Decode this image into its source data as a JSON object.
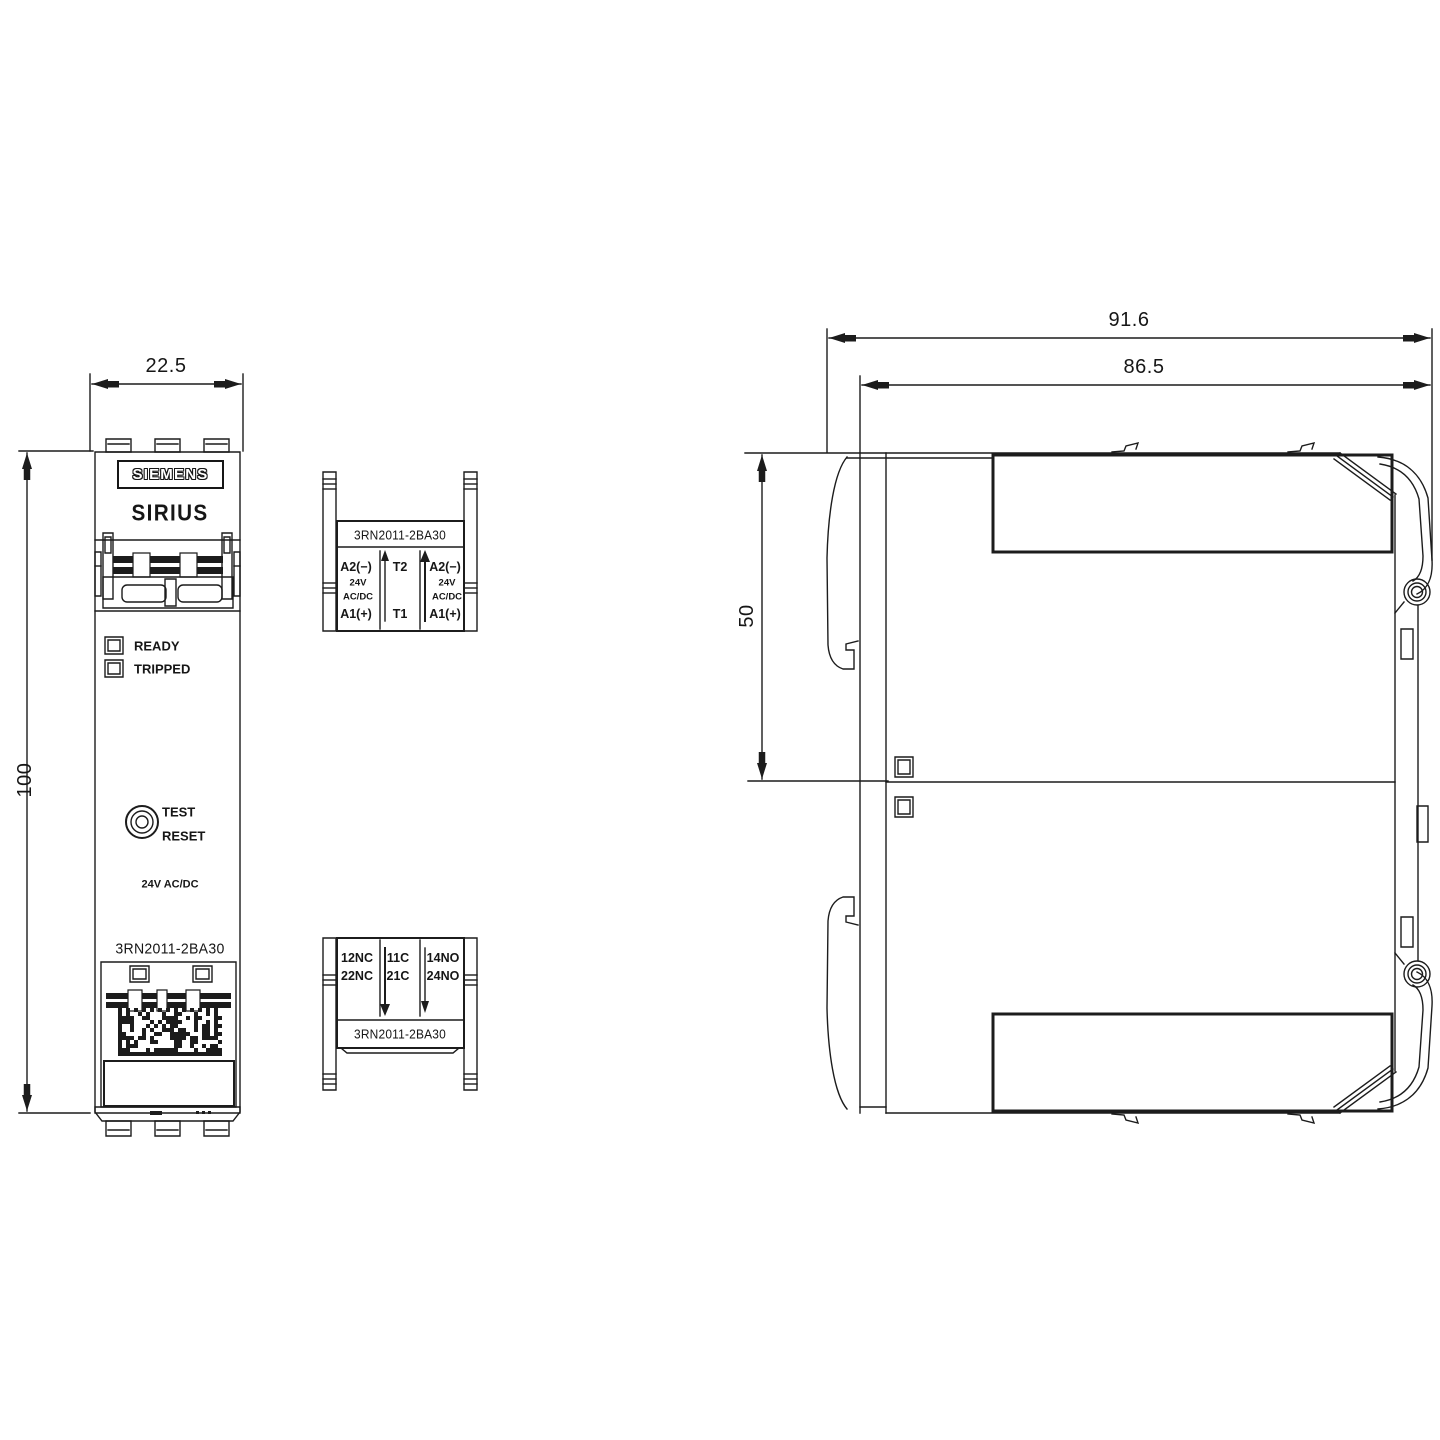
{
  "front_view": {
    "dim_width": "22.5",
    "dim_height": "100",
    "logo": "SIEMENS",
    "series": "SIRIUS",
    "led_ready": "READY",
    "led_tripped": "TRIPPED",
    "button_label_top": "TEST",
    "button_label_bottom": "RESET",
    "voltage": "24V AC/DC",
    "part_number": "3RN2011-2BA30"
  },
  "upper_terminal_block": {
    "part_number": "3RN2011-2BA30",
    "left": {
      "r1": "A2(−)",
      "r2": "24V",
      "r3": "AC/DC",
      "r4": "A1(+)"
    },
    "middle": {
      "r1": "T2",
      "r4": "T1"
    },
    "right": {
      "r1": "A2(−)",
      "r2": "24V",
      "r3": "AC/DC",
      "r4": "A1(+)"
    }
  },
  "lower_terminal_block": {
    "part_number": "3RN2011-2BA30",
    "left": {
      "r1": "12NC",
      "r2": "22NC"
    },
    "middle": {
      "r1": "11C",
      "r2": "21C"
    },
    "right": {
      "r1": "14NO",
      "r2": "24NO"
    }
  },
  "side_view": {
    "dim_overall_width": "91.6",
    "dim_body_width": "86.5",
    "dim_upper_height": "50"
  }
}
